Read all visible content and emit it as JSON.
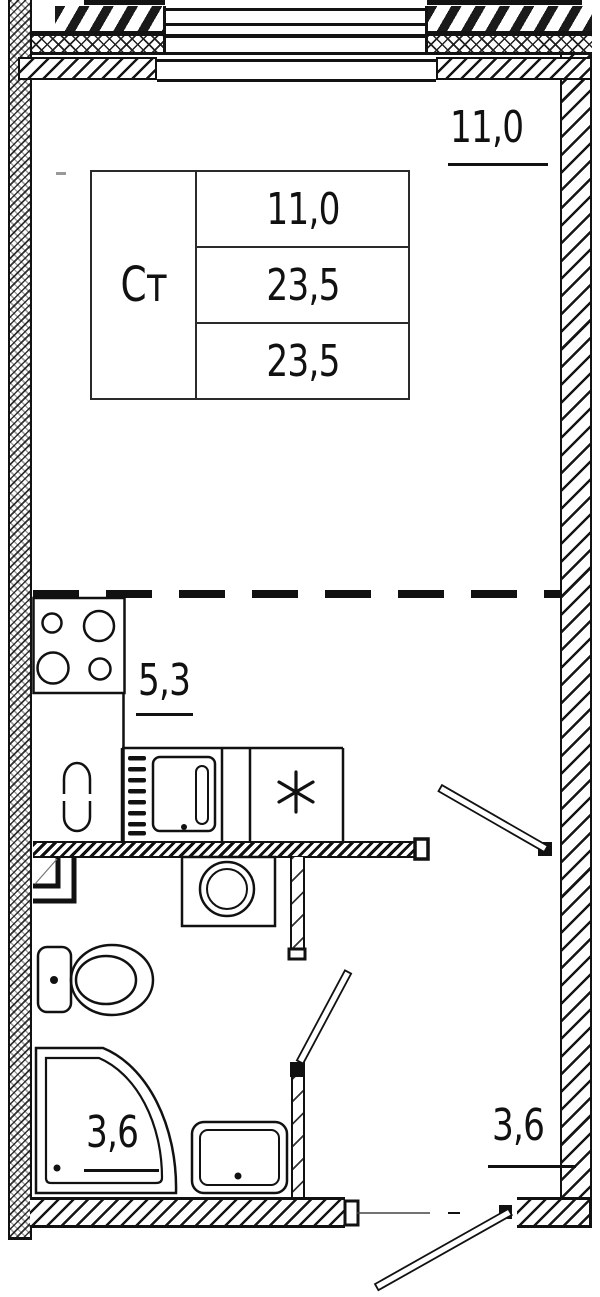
{
  "plan": {
    "legend_table": {
      "unit_label": "Ст",
      "values": [
        "11,0",
        "23,5",
        "23,5"
      ]
    },
    "room_labels": {
      "living": "11,0",
      "kitchen": "5,3",
      "bathroom": "3,6",
      "hallway": "3,6"
    },
    "symbols": {
      "washing_machine": "*"
    },
    "colors": {
      "ink": "#111111",
      "background": "#ffffff"
    }
  }
}
